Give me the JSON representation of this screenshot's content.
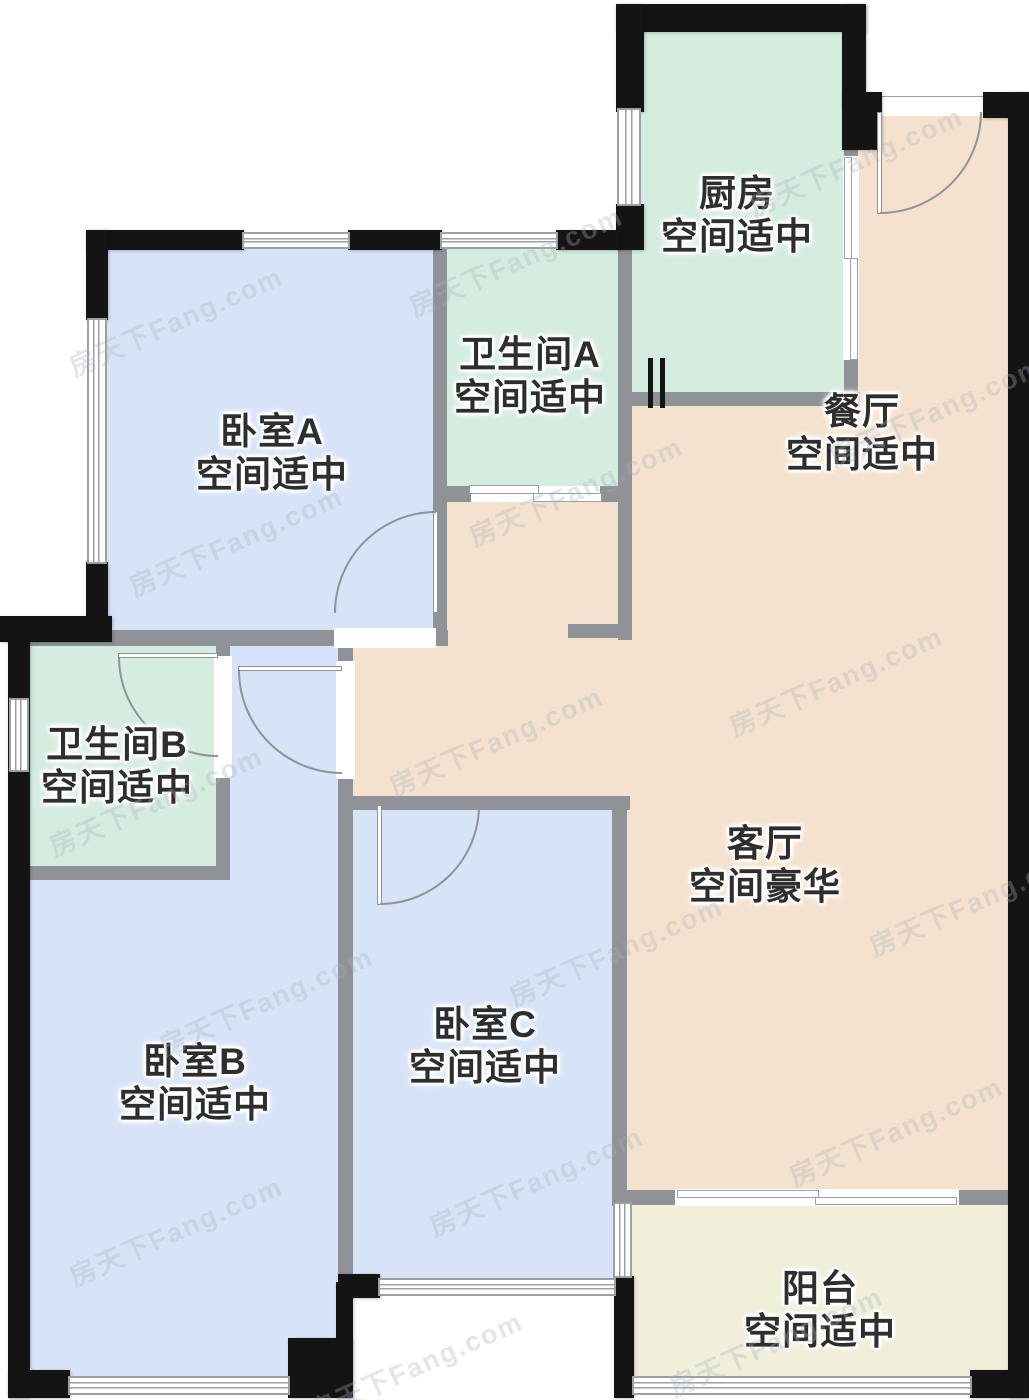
{
  "floorplan": {
    "watermark": "房天下Fang.com",
    "rooms": [
      {
        "id": "kitchen",
        "name": "厨房",
        "note": "空间适中"
      },
      {
        "id": "bathroom-a",
        "name": "卫生间A",
        "note": "空间适中"
      },
      {
        "id": "dining-room",
        "name": "餐厅",
        "note": "空间适中"
      },
      {
        "id": "bedroom-a",
        "name": "卧室A",
        "note": "空间适中"
      },
      {
        "id": "bathroom-b",
        "name": "卫生间B",
        "note": "空间适中"
      },
      {
        "id": "living-room",
        "name": "客厅",
        "note": "空间豪华"
      },
      {
        "id": "bedroom-c",
        "name": "卧室C",
        "note": "空间适中"
      },
      {
        "id": "bedroom-b",
        "name": "卧室B",
        "note": "空间适中"
      },
      {
        "id": "balcony",
        "name": "阳台",
        "note": "空间适中"
      }
    ],
    "palette": {
      "bedroom_fill": "#d7e3f7",
      "kitchen_bath_fill": "#d5ece1",
      "living_dining_fill": "#f4e2ce",
      "balcony_fill": "#efefda",
      "interior_wall": "#8f9296",
      "exterior_wall": "#141414",
      "label_text": "#2e2e2e",
      "watermark_color": "#aab2be"
    }
  }
}
